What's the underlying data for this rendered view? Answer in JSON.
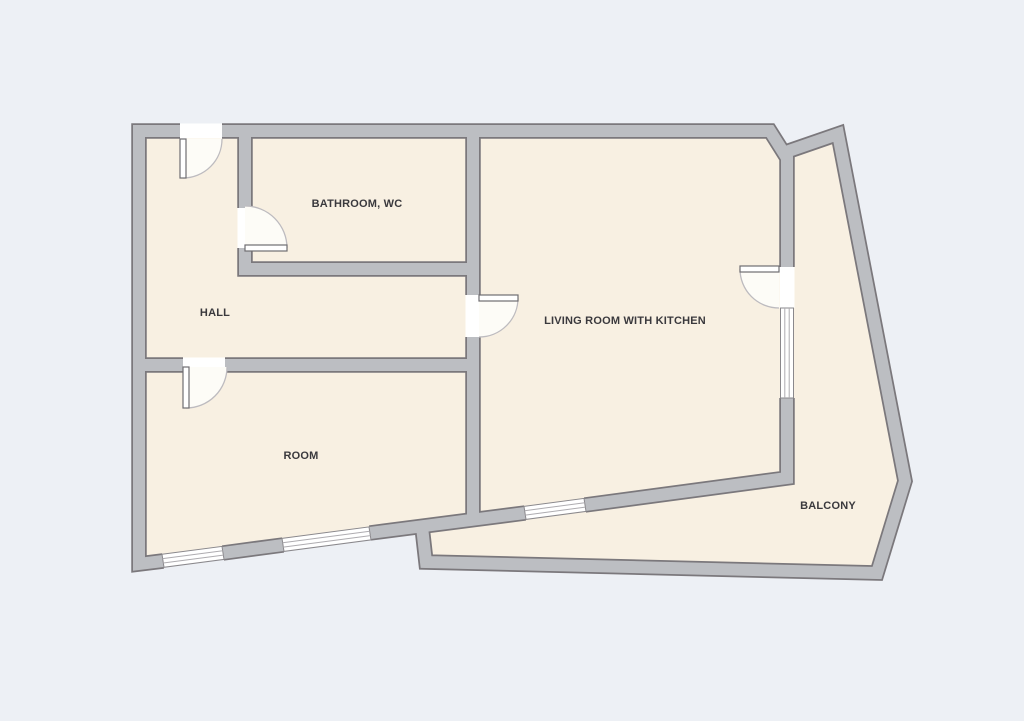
{
  "plan": {
    "rooms": [
      {
        "id": "bathroom",
        "label": "BATHROOM, WC"
      },
      {
        "id": "hall",
        "label": "HALL"
      },
      {
        "id": "living_room",
        "label": "LIVING ROOM WITH KITCHEN"
      },
      {
        "id": "room",
        "label": "ROOM"
      },
      {
        "id": "balcony",
        "label": "BALCONY"
      }
    ],
    "features": {
      "doors": [
        {
          "id": "entrance-door",
          "location": "top wall, opens into hall"
        },
        {
          "id": "bathroom-door",
          "location": "hall to bathroom, opens into bathroom"
        },
        {
          "id": "living-room-door",
          "location": "hall to living room, opens into living room"
        },
        {
          "id": "room-door",
          "location": "hall to room, opens into room"
        },
        {
          "id": "balcony-door",
          "location": "living room to balcony, opens into living room"
        }
      ],
      "windows": [
        {
          "id": "room-window-1",
          "location": "room, bottom wall left"
        },
        {
          "id": "room-window-2",
          "location": "room, bottom wall right"
        },
        {
          "id": "living-room-window-south",
          "location": "living room, bottom wall"
        },
        {
          "id": "living-room-window-east",
          "location": "living room, wall to balcony"
        }
      ]
    },
    "colors": {
      "background": "#edf0f5",
      "floor": "#f8f0e2",
      "wall_fill": "#bcbec2",
      "wall_outline": "#7b787c",
      "opening": "#ffffff",
      "window_frame": "#8a888c",
      "window_line": "#aeacb0",
      "door_swing": "#fdfcf7",
      "door_arc": "#bdbbbf",
      "door_leaf": "#6f6d71",
      "label": "#3a393d"
    }
  }
}
